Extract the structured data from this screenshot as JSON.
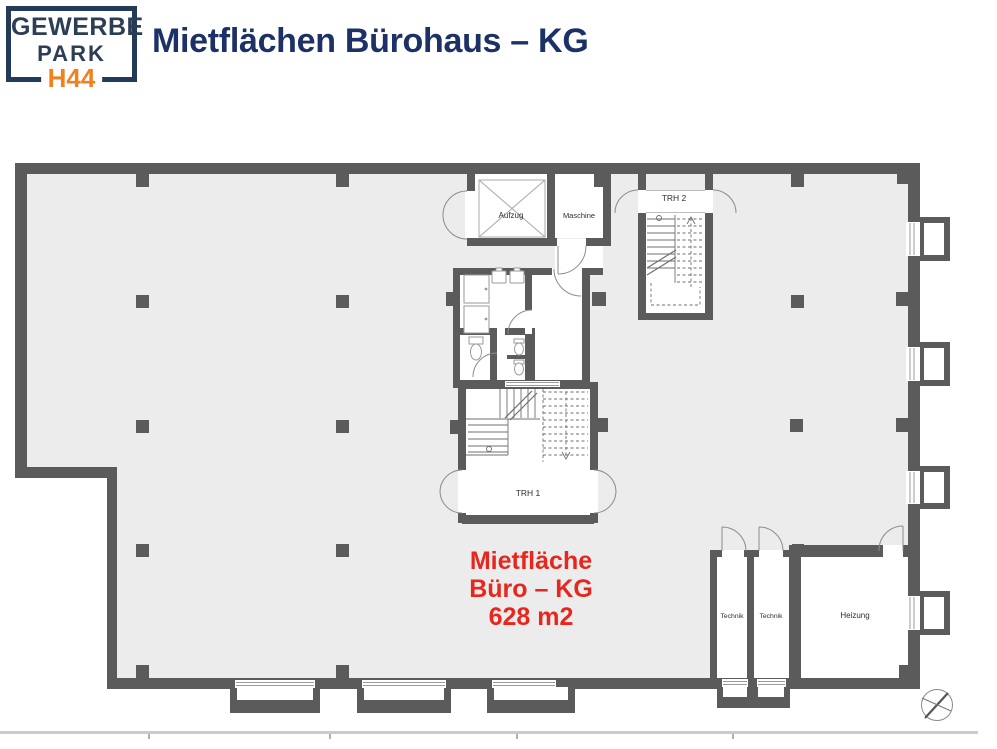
{
  "header": {
    "logo": {
      "top": "GEWERBE",
      "middle": "PARK",
      "bottom": "H44"
    },
    "title": "Mietflächen Bürohaus – KG"
  },
  "plan": {
    "labels": {
      "aufzug": "Aufzug",
      "maschine": "Maschine",
      "trh2": "TRH 2",
      "trh1": "TRH 1",
      "technik1": "Technik",
      "technik2": "Technik",
      "heizung": "Heizung"
    },
    "area_label": {
      "line1": "Mietfläche",
      "line2": "Büro – KG",
      "line3": "628 m2"
    }
  },
  "colors": {
    "navy_title": "#1c3166",
    "navy_logo": "#2c3e54",
    "orange_logo": "#f0811f",
    "red_area_label": "#e7261d",
    "wall_gray": "#5b5b5b",
    "floor_gray": "#ececec"
  },
  "icons": {
    "compass": "north-arrow"
  }
}
